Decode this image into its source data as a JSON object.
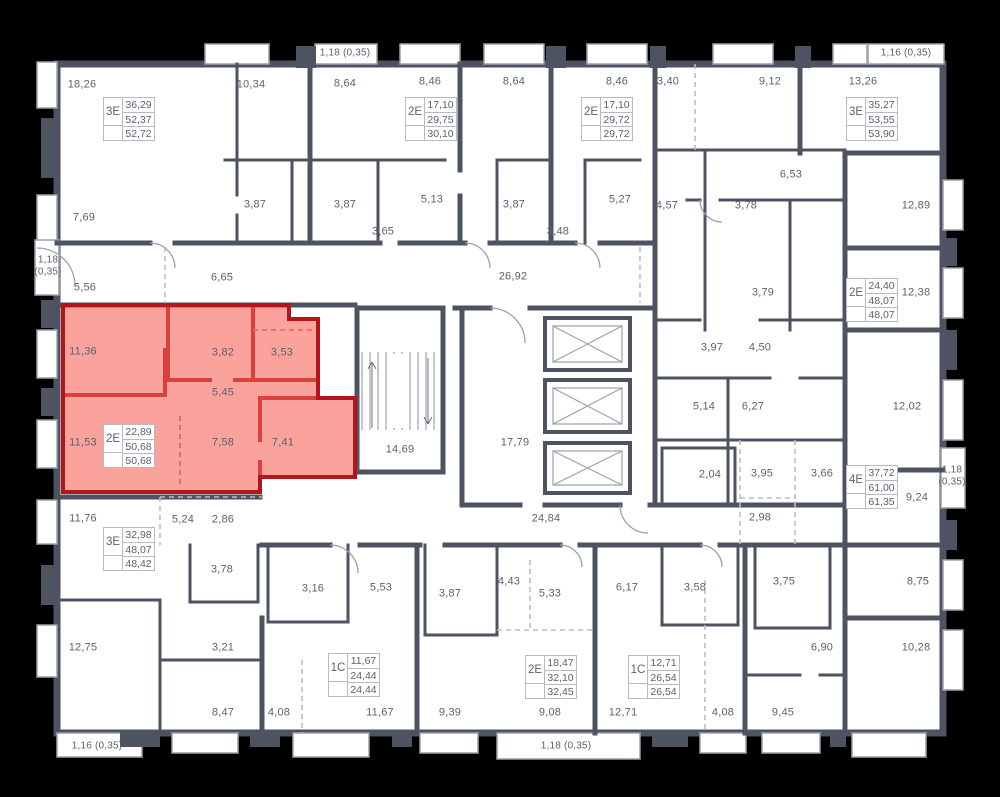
{
  "palette": {
    "wall": "#4d5360",
    "text": "#5b6170",
    "light_line": "#9ba1ac",
    "highlight_fill": "#f6584d",
    "highlight_border": "#b2151b",
    "background": "#000000",
    "floor": "#ffffff"
  },
  "rooms": [
    "18,26",
    "10,34",
    "8,64",
    "8,46",
    "8,64",
    "8,46",
    "3,40",
    "9,12",
    "13,26",
    "3,87",
    "3,87",
    "5,13",
    "3,87",
    "5,27",
    "4,57",
    "3,65",
    "3,48",
    "7,69",
    "6,65",
    "5,56",
    "26,92",
    "6,53",
    "3,78",
    "12,89",
    "3,79",
    "12,38",
    "3,97",
    "4,50",
    "5,14",
    "6,27",
    "12,02",
    "11,36",
    "3,82",
    "3,53",
    "5,45",
    "11,53",
    "7,58",
    "7,41",
    "14,69",
    "17,79",
    "24,84",
    "2,04",
    "3,95",
    "3,66",
    "9,24",
    "2,98",
    "11,76",
    "5,24",
    "2,86",
    "3,78",
    "3,16",
    "12,75",
    "3,21",
    "8,47",
    "4,08",
    "5,53",
    "3,87",
    "4,43",
    "5,33",
    "6,17",
    "11,67",
    "9,39",
    "9,08",
    "12,71",
    "3,58",
    "3,75",
    "8,75",
    "6,90",
    "10,28",
    "4,08",
    "9,45"
  ],
  "edge_labels": [
    "1,18 (0,35)",
    "1,16 (0,35)",
    "1,18\n(0,35)",
    "1,18\n(0,35)",
    "1,16 (0,35)",
    "1,18 (0,35)"
  ],
  "units": [
    {
      "type": "3E",
      "values": [
        "36,29",
        "52,37",
        "52,72"
      ]
    },
    {
      "type": "2E",
      "values": [
        "17,10",
        "29,75",
        "30,10"
      ]
    },
    {
      "type": "2E",
      "values": [
        "17,10",
        "29,72",
        "29,72"
      ]
    },
    {
      "type": "3E",
      "values": [
        "35,27",
        "53,55",
        "53,90"
      ]
    },
    {
      "type": "2E",
      "values": [
        "24,40",
        "48,07",
        "48,07"
      ]
    },
    {
      "type": "4E",
      "values": [
        "37,72",
        "61,00",
        "61,35"
      ]
    },
    {
      "type": "2E",
      "values": [
        "22,89",
        "50,68",
        "50,68"
      ]
    },
    {
      "type": "3E",
      "values": [
        "32,98",
        "48,07",
        "48,42"
      ]
    },
    {
      "type": "1C",
      "values": [
        "11,67",
        "24,44",
        "24,44"
      ]
    },
    {
      "type": "2E",
      "values": [
        "18,47",
        "32,10",
        "32,45"
      ]
    },
    {
      "type": "1C",
      "values": [
        "12,71",
        "26,54",
        "26,54"
      ]
    }
  ]
}
